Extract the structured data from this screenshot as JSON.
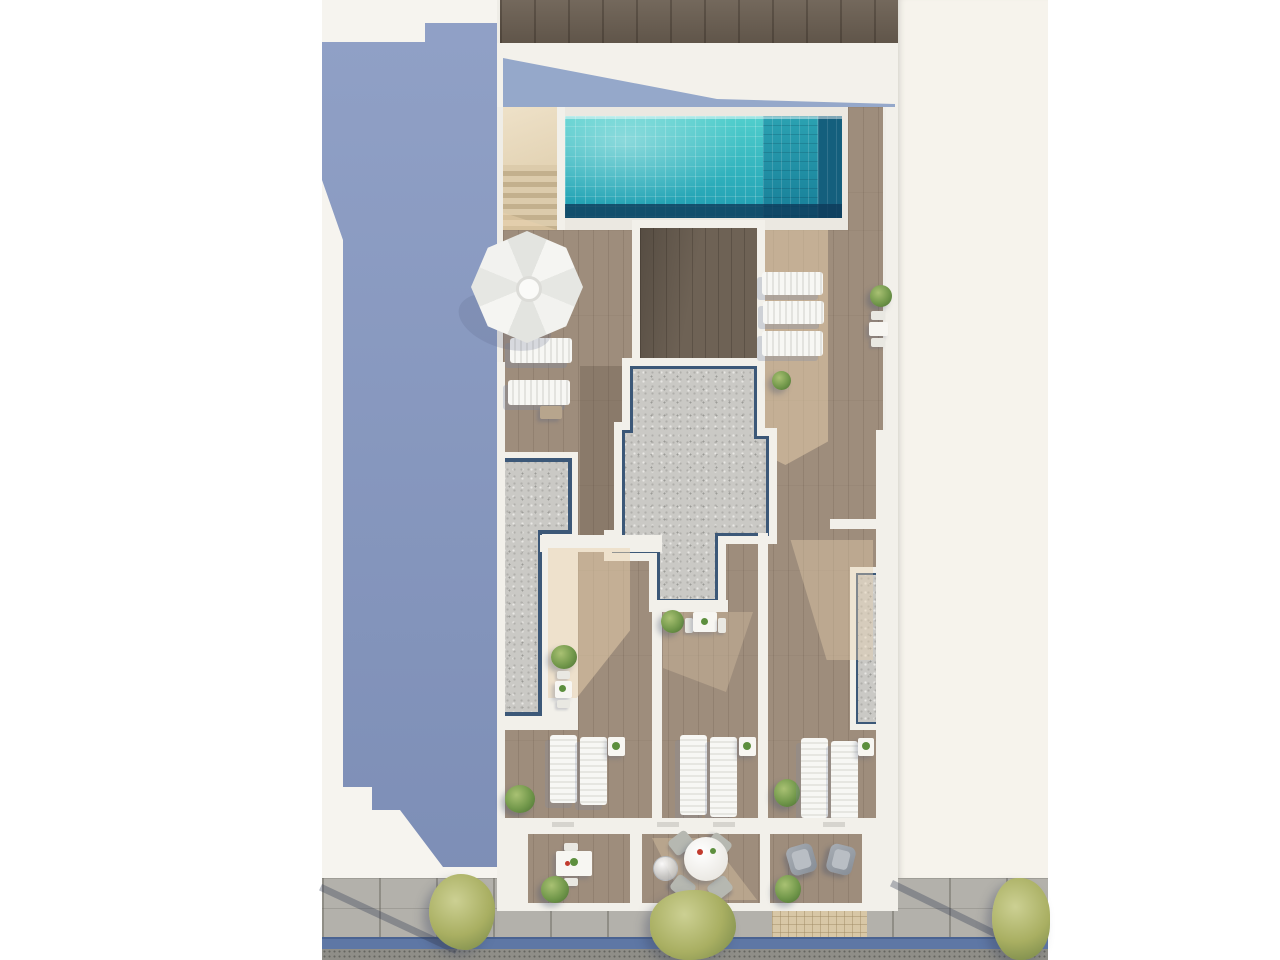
{
  "meta": {
    "title": "Aerial 3D architectural render of a rooftop terrace with swimming pool",
    "type": "top-down bird's-eye rendering, no visible text",
    "canvas": {
      "width": 1280,
      "height": 960
    }
  },
  "palette": {
    "page_background": "#ffffff",
    "adjacent_roof_shadow_blue": "#8496c0",
    "white_walls": "#f2f0ea",
    "deck_wood_mid": "#9e8d7c",
    "deck_wood_dark": "#6e6255",
    "facade_wood_top": "#6b5f52",
    "bleached_sunlit_wood": "#e9d2ae",
    "gravel_roof": "#cac9c5",
    "pool_water": "#3fc3c5",
    "pool_bench_teal": "#2095a8",
    "pool_shadow_navy": "#145f7d",
    "right_plot_offwhite": "#f6f3ec",
    "sidewalk_gray": "#b3b1ab",
    "bike_lane_blue": "#5e77a5",
    "road_asphalt": "#8f8e88",
    "driveway_tan_pavers": "#d8c7a6",
    "street_tree_foliage": "#a9af62",
    "plant_green": "#72984b"
  },
  "scene": {
    "left_building": "adjacent flat roof in blue shadow with white parapet edges",
    "right_building": "off-white neighbouring plot",
    "main_roof": {
      "pool": {
        "shape": "rectangular",
        "tiles": "turquoise mosaic",
        "features": [
          "submerged bench on right side",
          "navy shadow edge",
          "corner staircase access on left"
        ]
      },
      "gravel_zones": [
        "central irregular skylight block with navy trim",
        "left L-shaped planter strip",
        "right planter strip"
      ],
      "rooms": [
        "dark wood stair-core roof below pool",
        "three lounger terraces in middle band",
        "three street-facing balconies"
      ]
    },
    "street": {
      "elements": [
        "stone slab sidewalk",
        "blue bike lane strip",
        "asphalt road edge",
        "tan paver driveway"
      ],
      "trees": 3
    }
  },
  "inventory": {
    "parasols": 1,
    "sun_loungers": 11,
    "small_side_tables": 7,
    "dining_table_sets": 4,
    "round_dining_table": 1,
    "armchairs": 2,
    "potted_plants_and_bushes": 10,
    "street_trees": 3
  }
}
